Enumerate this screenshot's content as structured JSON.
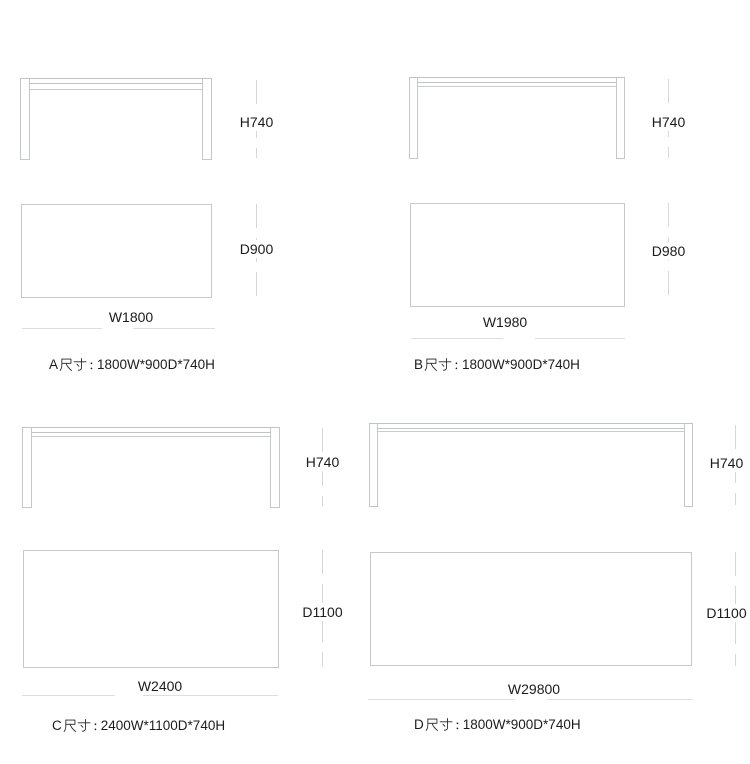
{
  "colors": {
    "background": "#ffffff",
    "drawing_outline": "#c3c7c7",
    "dimension_line": "#d8d8d8",
    "text": "#1b1b1b"
  },
  "figures": [
    {
      "name": "A",
      "front_view": {
        "height_dim": "H740"
      },
      "top_view": {
        "depth_dim": "D900",
        "width_dim": "W1800"
      },
      "caption": {
        "full_text": "A尺寸：1800W*900D*740H",
        "prefix": "A",
        "size_word": "尺寸",
        "separator": "：",
        "dimensions": "1800W*900D*740H"
      }
    },
    {
      "name": "B",
      "front_view": {
        "height_dim": "H740"
      },
      "top_view": {
        "depth_dim": "D980",
        "width_dim": "W1980"
      },
      "caption": {
        "full_text": "B尺寸：1800W*900D*740H",
        "prefix": "B",
        "size_word": "尺寸",
        "separator": "：",
        "dimensions": "1800W*900D*740H"
      }
    },
    {
      "name": "C",
      "front_view": {
        "height_dim": "H740"
      },
      "top_view": {
        "depth_dim": "D1100",
        "width_dim": "W2400"
      },
      "caption": {
        "full_text": "C尺寸：2400W*1100D*740H",
        "prefix": "C",
        "size_word": "尺寸",
        "separator": "：",
        "dimensions": "2400W*1100D*740H"
      }
    },
    {
      "name": "D",
      "front_view": {
        "height_dim": "H740"
      },
      "top_view": {
        "depth_dim": "D1100",
        "width_dim": "W29800"
      },
      "caption": {
        "full_text": "D尺寸：1800W*900D*740H",
        "prefix": "D",
        "size_word": "尺寸",
        "separator": "：",
        "dimensions": "1800W*900D*740H"
      }
    }
  ]
}
